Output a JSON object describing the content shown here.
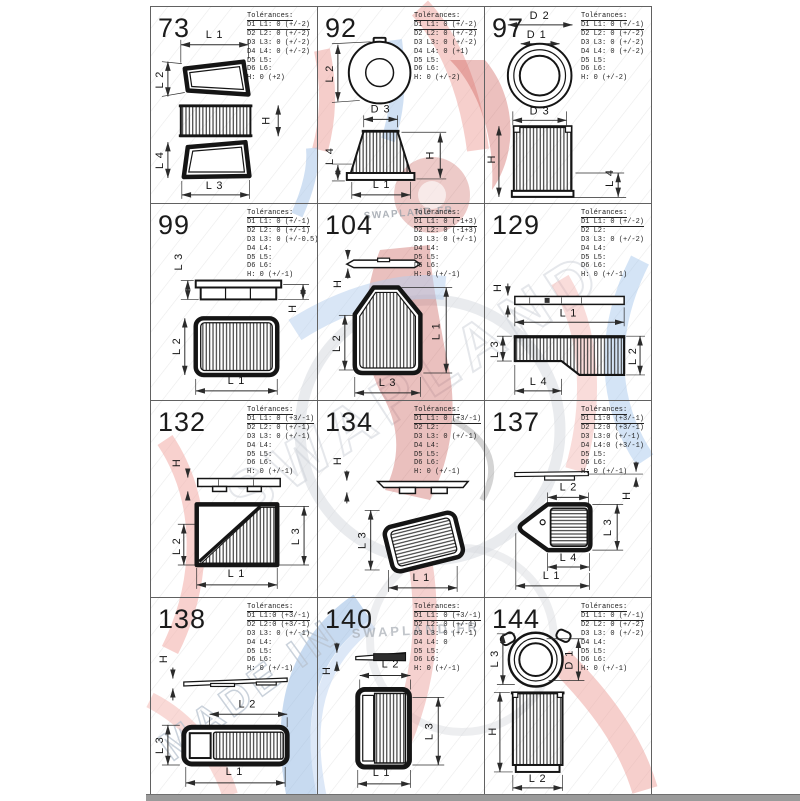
{
  "watermark": {
    "texts": [
      {
        "label": "SWAPLAND.FR"
      },
      {
        "label": "SWAPLAND.FR"
      },
      {
        "label": "MADE IN"
      }
    ],
    "colors": {
      "red": "#eda09a",
      "blue": "#9fc3ea",
      "gray": "#ccd1d8",
      "dark_red": "#c4504a"
    }
  },
  "cells": [
    {
      "number": "73",
      "tol": {
        "title": "Tolérances:",
        "rows": [
          "D1 L1: 0 (+/-2)",
          "D2 L2: 0 (+/-2)",
          "D3 L3: 0 (+/-2)",
          "D4 L4: 0 (+/-2)",
          "D5 L5:",
          "D6 L6:",
          "H: 0 (+2)"
        ]
      },
      "dims": [
        "L 1",
        "L 2",
        "H",
        "L 4",
        "L 3"
      ]
    },
    {
      "number": "92",
      "tol": {
        "title": "Tolérances:",
        "rows": [
          "D1 L1: 0 (+/-2)",
          "D2 L2: 0 (+/-2)",
          "D3 L3: 0 (+/-2)",
          "D4 L4: 0 (+1)",
          "D5 L5:",
          "D6 L6:",
          "H: 0 (+/-2)"
        ]
      },
      "dims": [
        "L 2",
        "D 3",
        "L 4",
        "H",
        "L 1"
      ]
    },
    {
      "number": "97",
      "tol": {
        "title": "Tolérances:",
        "rows": [
          "D1 L1: 0 (+/-1)",
          "D2 L2: 0 (+/-2)",
          "D3 L3: 0 (+/-2)",
          "D4 L4: 0 (+/-2)",
          "D5 L5:",
          "D6 L6:",
          "H: 0 (+/-2)"
        ]
      },
      "dims": [
        "D 2",
        "D 1",
        "D 3",
        "H",
        "L 4"
      ]
    },
    {
      "number": "99",
      "tol": {
        "title": "Tolérances:",
        "rows": [
          "D1 L1: 0 (+/-1)",
          "D2 L2: 0 (+/-1)",
          "D3 L3: 0 (+/-0.5)",
          "D4 L4:",
          "D5 L5:",
          "D6 L6:",
          "H: 0 (+/-1)"
        ]
      },
      "dims": [
        "L 3",
        "H",
        "L 2",
        "L 1"
      ]
    },
    {
      "number": "104",
      "tol": {
        "title": "Tolérances:",
        "rows": [
          "D1 L1: 0 (-1+3)",
          "D2 L2: 0 (-1+3)",
          "D3 L3: 0 (+/-1)",
          "D4 L4:",
          "D5 L5:",
          "D6 L6:",
          "H: 0 (+/-1)"
        ]
      },
      "dims": [
        "H",
        "L 2",
        "L 1",
        "L 3"
      ]
    },
    {
      "number": "129",
      "tol": {
        "title": "Tolérances:",
        "rows": [
          "D1 L1: 0 (+/-2)",
          "D2 L2:",
          "D3 L3: 0 (+/-2)",
          "D4 L4:",
          "D5 L5:",
          "D6 L6:",
          "H: 0 (+/-1)"
        ]
      },
      "dims": [
        "H",
        "L 1",
        "L 3",
        "L 2",
        "L 4"
      ]
    },
    {
      "number": "132",
      "tol": {
        "title": "Tolérances:",
        "rows": [
          "D1 L1: 0 (+3/-1)",
          "D2 L2: 0 (+/-1)",
          "D3 L3: 0 (+/-1)",
          "D4 L4:",
          "D5 L5:",
          "D6 L6:",
          "H: 0 (+/-1)"
        ]
      },
      "dims": [
        "H",
        "L 2",
        "L 3",
        "L 1"
      ]
    },
    {
      "number": "134",
      "tol": {
        "title": "Tolérances:",
        "rows": [
          "D1 L1: 0 (+3/-1)",
          "D2 L2:",
          "D3 L3: 0 (+/-1)",
          "D4 L4:",
          "D5 L5:",
          "D6 L6:",
          "H: 0 (+/-1)"
        ]
      },
      "dims": [
        "H",
        "L 3",
        "L 1"
      ]
    },
    {
      "number": "137",
      "tol": {
        "title": "Tolérances:",
        "rows": [
          "D1 L1:0 (+3/-1)",
          "D2 L2:0 (+3/-1)",
          "D3 L3:0 (+/-1)",
          "D4 L4:0 (+3/-1)",
          "D5 L5:",
          "D6 L6:",
          "H: 0 (+/-1)"
        ]
      },
      "dims": [
        "H",
        "L 2",
        "L 3",
        "L 4",
        "L 1"
      ]
    },
    {
      "number": "138",
      "tol": {
        "title": "Tolérances:",
        "rows": [
          "D1 L1:0 (+3/-1)",
          "D2 L2:0 (+3/-1)",
          "D3 L3: 0 (+/-1)",
          "D4 L4:",
          "D5 L5:",
          "D6 L6:",
          "H: 0 (+/-1)"
        ]
      },
      "dims": [
        "H",
        "L 2",
        "L 3",
        "L 1"
      ]
    },
    {
      "number": "140",
      "tol": {
        "title": "Tolérances:",
        "rows": [
          "D1 L1: 0 (+3/-1)",
          "D2 L2: 0 (+/-1)",
          "D3 L3: 0 (+/-1)",
          "D4 L4: 0",
          "D5 L5:",
          "D6 L6:",
          "H: 0 (+/-1)"
        ]
      },
      "dims": [
        "H",
        "L 2",
        "L 3",
        "L 1"
      ]
    },
    {
      "number": "144",
      "tol": {
        "title": "Tolérances:",
        "rows": [
          "D1 L1: 0 (+/-1)",
          "D2 L2: 0 (+/-2)",
          "D3 L3: 0 (+/-2)",
          "D4 L4:",
          "D5 L5:",
          "D6 L6:",
          "H: 0 (+/-1)"
        ]
      },
      "dims": [
        "L 3",
        "D 1",
        "H",
        "L 2"
      ]
    }
  ]
}
